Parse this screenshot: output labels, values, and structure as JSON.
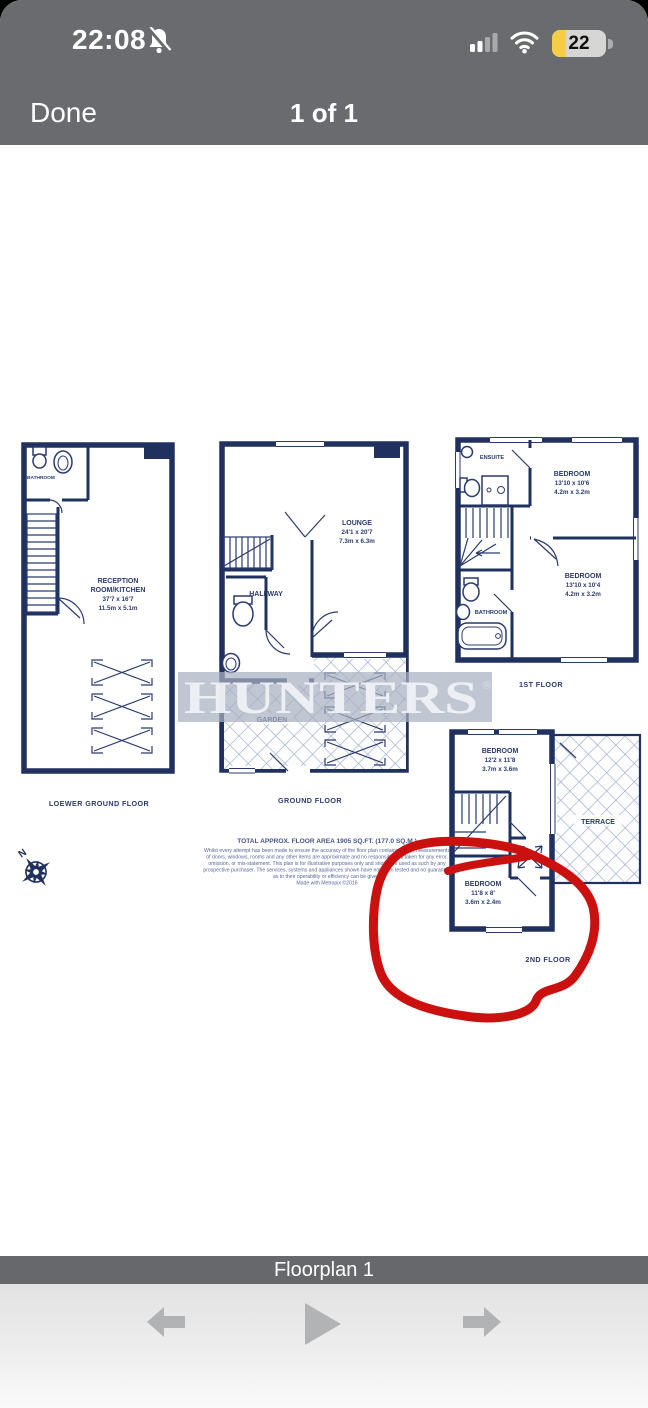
{
  "status_bar": {
    "time": "22:08",
    "battery_percent": "22",
    "icons": [
      "notifications-muted",
      "cellular-signal",
      "wifi",
      "battery"
    ]
  },
  "nav_bar": {
    "done_label": "Done",
    "page_indicator": "1 of 1"
  },
  "floorplan": {
    "watermark": "HUNTERS",
    "registered_mark": "®",
    "floors": {
      "lower_ground": {
        "label": "LOEWER GROUND FLOOR",
        "bathroom": "BATHROOM",
        "reception": {
          "line1": "RECEPTION",
          "line2": "ROOM/KITCHEN",
          "imperial": "37'7 x 16'7",
          "metric": "11.5m x 5.1m"
        }
      },
      "ground": {
        "label": "GROUND FLOOR",
        "lounge": {
          "name": "LOUNGE",
          "imperial": "24'1 x 20'7",
          "metric": "7.3m x 6.3m"
        },
        "hallway": "HALLWAY",
        "garden": "GARDEN"
      },
      "first": {
        "label": "1ST FLOOR",
        "ensuite": "ENSUITE",
        "bedroom1": {
          "name": "BEDROOM",
          "imperial": "13'10 x 10'6",
          "metric": "4.2m x 3.2m"
        },
        "bedroom2": {
          "name": "BEDROOM",
          "imperial": "13'10 x 10'4",
          "metric": "4.2m x 3.2m"
        },
        "bathroom": "BATHROOM"
      },
      "second": {
        "label": "2ND FLOOR",
        "bedroom1": {
          "name": "BEDROOM",
          "imperial": "12'2 x 11'8",
          "metric": "3.7m x 3.6m"
        },
        "terrace": "TERRACE",
        "bedroom2": {
          "name": "BEDROOM",
          "imperial": "11'8 x 8'",
          "metric": "3.6m x 2.4m"
        }
      }
    },
    "disclaimer": {
      "title": "TOTAL APPROX. FLOOR AREA 1905 SQ.FT. (177.0 SQ.M.)",
      "lines": [
        "Whilst every attempt has been made to ensure the accuracy of the floor plan contained here, measurements",
        "of doors, windows, rooms and any other items are approximate and no responsibility is taken for any error,",
        "omission, or mis-statement. This plan is for illustrative purposes only and should be used as such by any",
        "prospective purchaser. The services, systems and appliances shown have not been tested and no guarantee",
        "as to their operability or efficiency can be given.",
        "Made with Metropix ©2016"
      ]
    }
  },
  "footer": {
    "caption": "Floorplan 1"
  },
  "colors": {
    "wall_navy": "#20305f",
    "annotation_red": "#cb1110",
    "chrome_gray": "#6a6b6f",
    "battery_yellow": "#f6ce45",
    "lattice_blue": "#9aa9c9"
  }
}
